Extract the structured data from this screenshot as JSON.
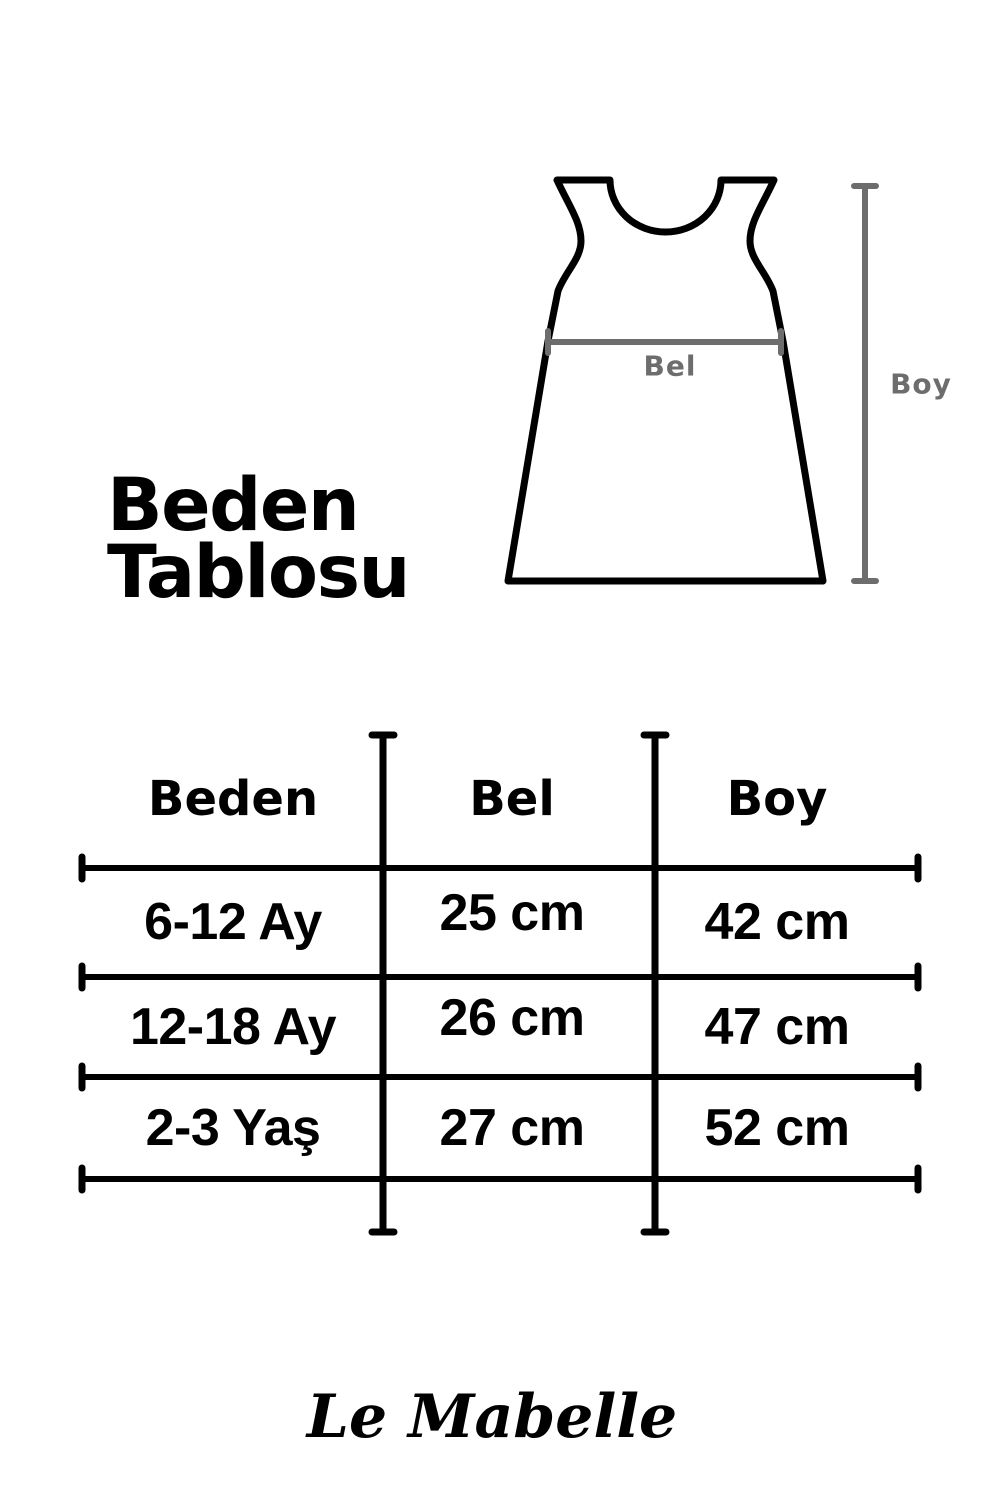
{
  "title": "Beden\nTablosu",
  "diagram": {
    "waist_label": "Bel",
    "height_label": "Boy"
  },
  "colors": {
    "ink": "#000000",
    "measure": "#6d6d6d"
  },
  "size_table": {
    "columns": [
      "Beden",
      "Bel",
      "Boy"
    ],
    "rows": [
      {
        "size": "6-12 Ay",
        "waist": "25 cm",
        "height": "42 cm"
      },
      {
        "size": "12-18 Ay",
        "waist": "26 cm",
        "height": "47 cm"
      },
      {
        "size": "2-3 Yaş",
        "waist": "27 cm",
        "height": "52 cm"
      }
    ]
  },
  "brand": "Le Mabelle"
}
